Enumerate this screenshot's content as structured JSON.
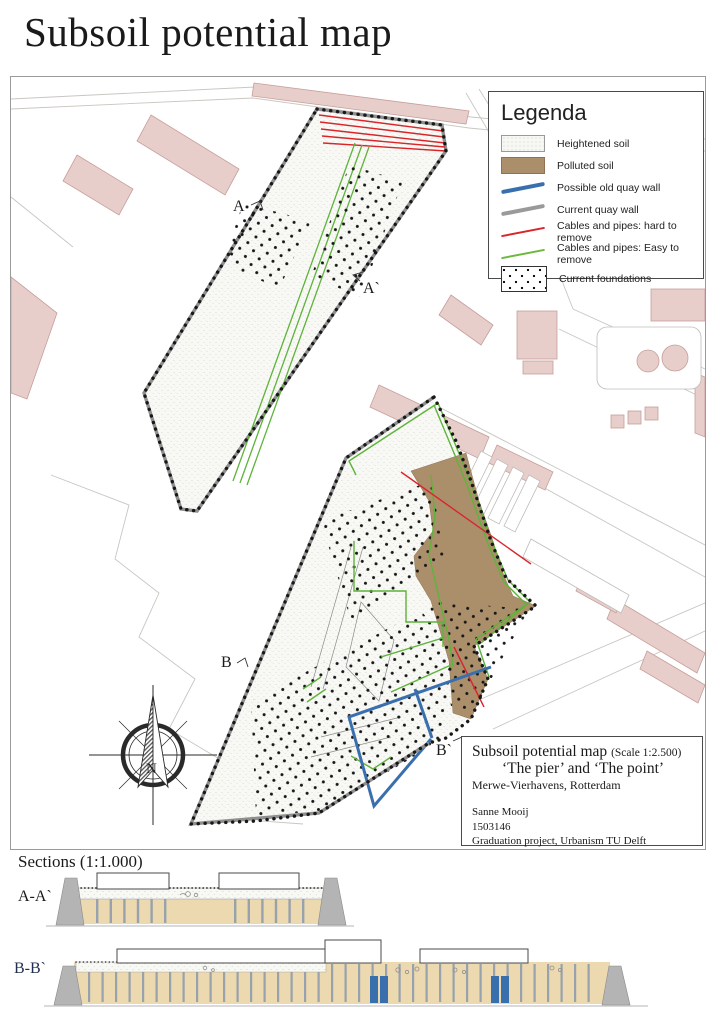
{
  "page": {
    "title": "Subsoil potential map"
  },
  "legend": {
    "title": "Legenda",
    "items": [
      {
        "label": "Heightened soil",
        "swatch": "stipple"
      },
      {
        "label": "Polluted soil",
        "swatch": "brown",
        "color": "#ab8f6b"
      },
      {
        "label": "Possible old quay wall",
        "swatch": "line",
        "color": "#3a6fae"
      },
      {
        "label": "Current quay wall",
        "swatch": "line",
        "color": "#9a9a9a"
      },
      {
        "label": "Cables and pipes: hard to remove",
        "swatch": "line-thin",
        "color": "#d8262c"
      },
      {
        "label": "Cables and pipes: Easy to remove",
        "swatch": "line-thin",
        "color": "#6cb93e"
      },
      {
        "label": "Current foundations",
        "swatch": "dots"
      }
    ]
  },
  "title_block": {
    "title": "Subsoil potential map ",
    "scale_note": "(Scale 1:2.500)",
    "subtitle": "‘The pier’ and ‘The point’",
    "location": "Merwe-Vierhavens, Rotterdam",
    "author": "Sanne Mooij",
    "student_number": "1503146",
    "project": "Graduation project, Urbanism TU Delft"
  },
  "map": {
    "section_labels": {
      "a": "A",
      "a_prime": "A`",
      "b": "B",
      "b_prime": "B`"
    },
    "compass_label": "N",
    "colors": {
      "heightened_soil": "#f7f7f4",
      "polluted_soil": "#ab8f6b",
      "possible_old_quay_wall": "#3a6fae",
      "current_quay_wall": "#8f8f8f",
      "cables_hard_to_remove": "#d8262c",
      "cables_easy_to_remove": "#5eb33b",
      "foundation_dots": "#1a1a1a",
      "building_fill": "#e7cecb",
      "building_stroke": "#c79e9a",
      "section_soil": "#ecd9b0"
    }
  },
  "sections": {
    "heading": "Sections (1:1.000)",
    "items": [
      {
        "label": "A-A`"
      },
      {
        "label": "B-B`"
      }
    ]
  }
}
